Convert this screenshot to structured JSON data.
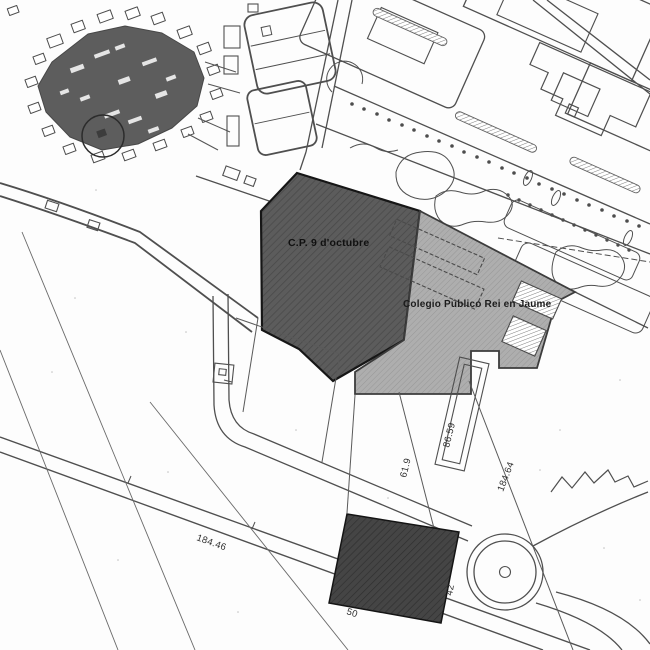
{
  "map": {
    "type": "cadastral-site-plan",
    "background_color": "#fdfdfd",
    "colors": {
      "line": "#4f4f4f",
      "dark_line": "#1a1a1a"
    },
    "inset": {
      "name": "town-overview-inset",
      "marker": "location-circle"
    },
    "parcels": {
      "cp9": {
        "label": "C.P. 9 d'octubre",
        "fill": "#5c5c5c"
      },
      "rei_jaume": {
        "label": "Colegio Público Rei en Jaume",
        "fill": "#aeaeae"
      },
      "south_plot": {
        "fill": "#454545"
      }
    },
    "dimensions": {
      "road_length": "184.46",
      "strip_length": "61.9",
      "building_length": "86.59",
      "boundary_length": "184.64",
      "plot_width": "50",
      "plot_depth": "42"
    }
  }
}
